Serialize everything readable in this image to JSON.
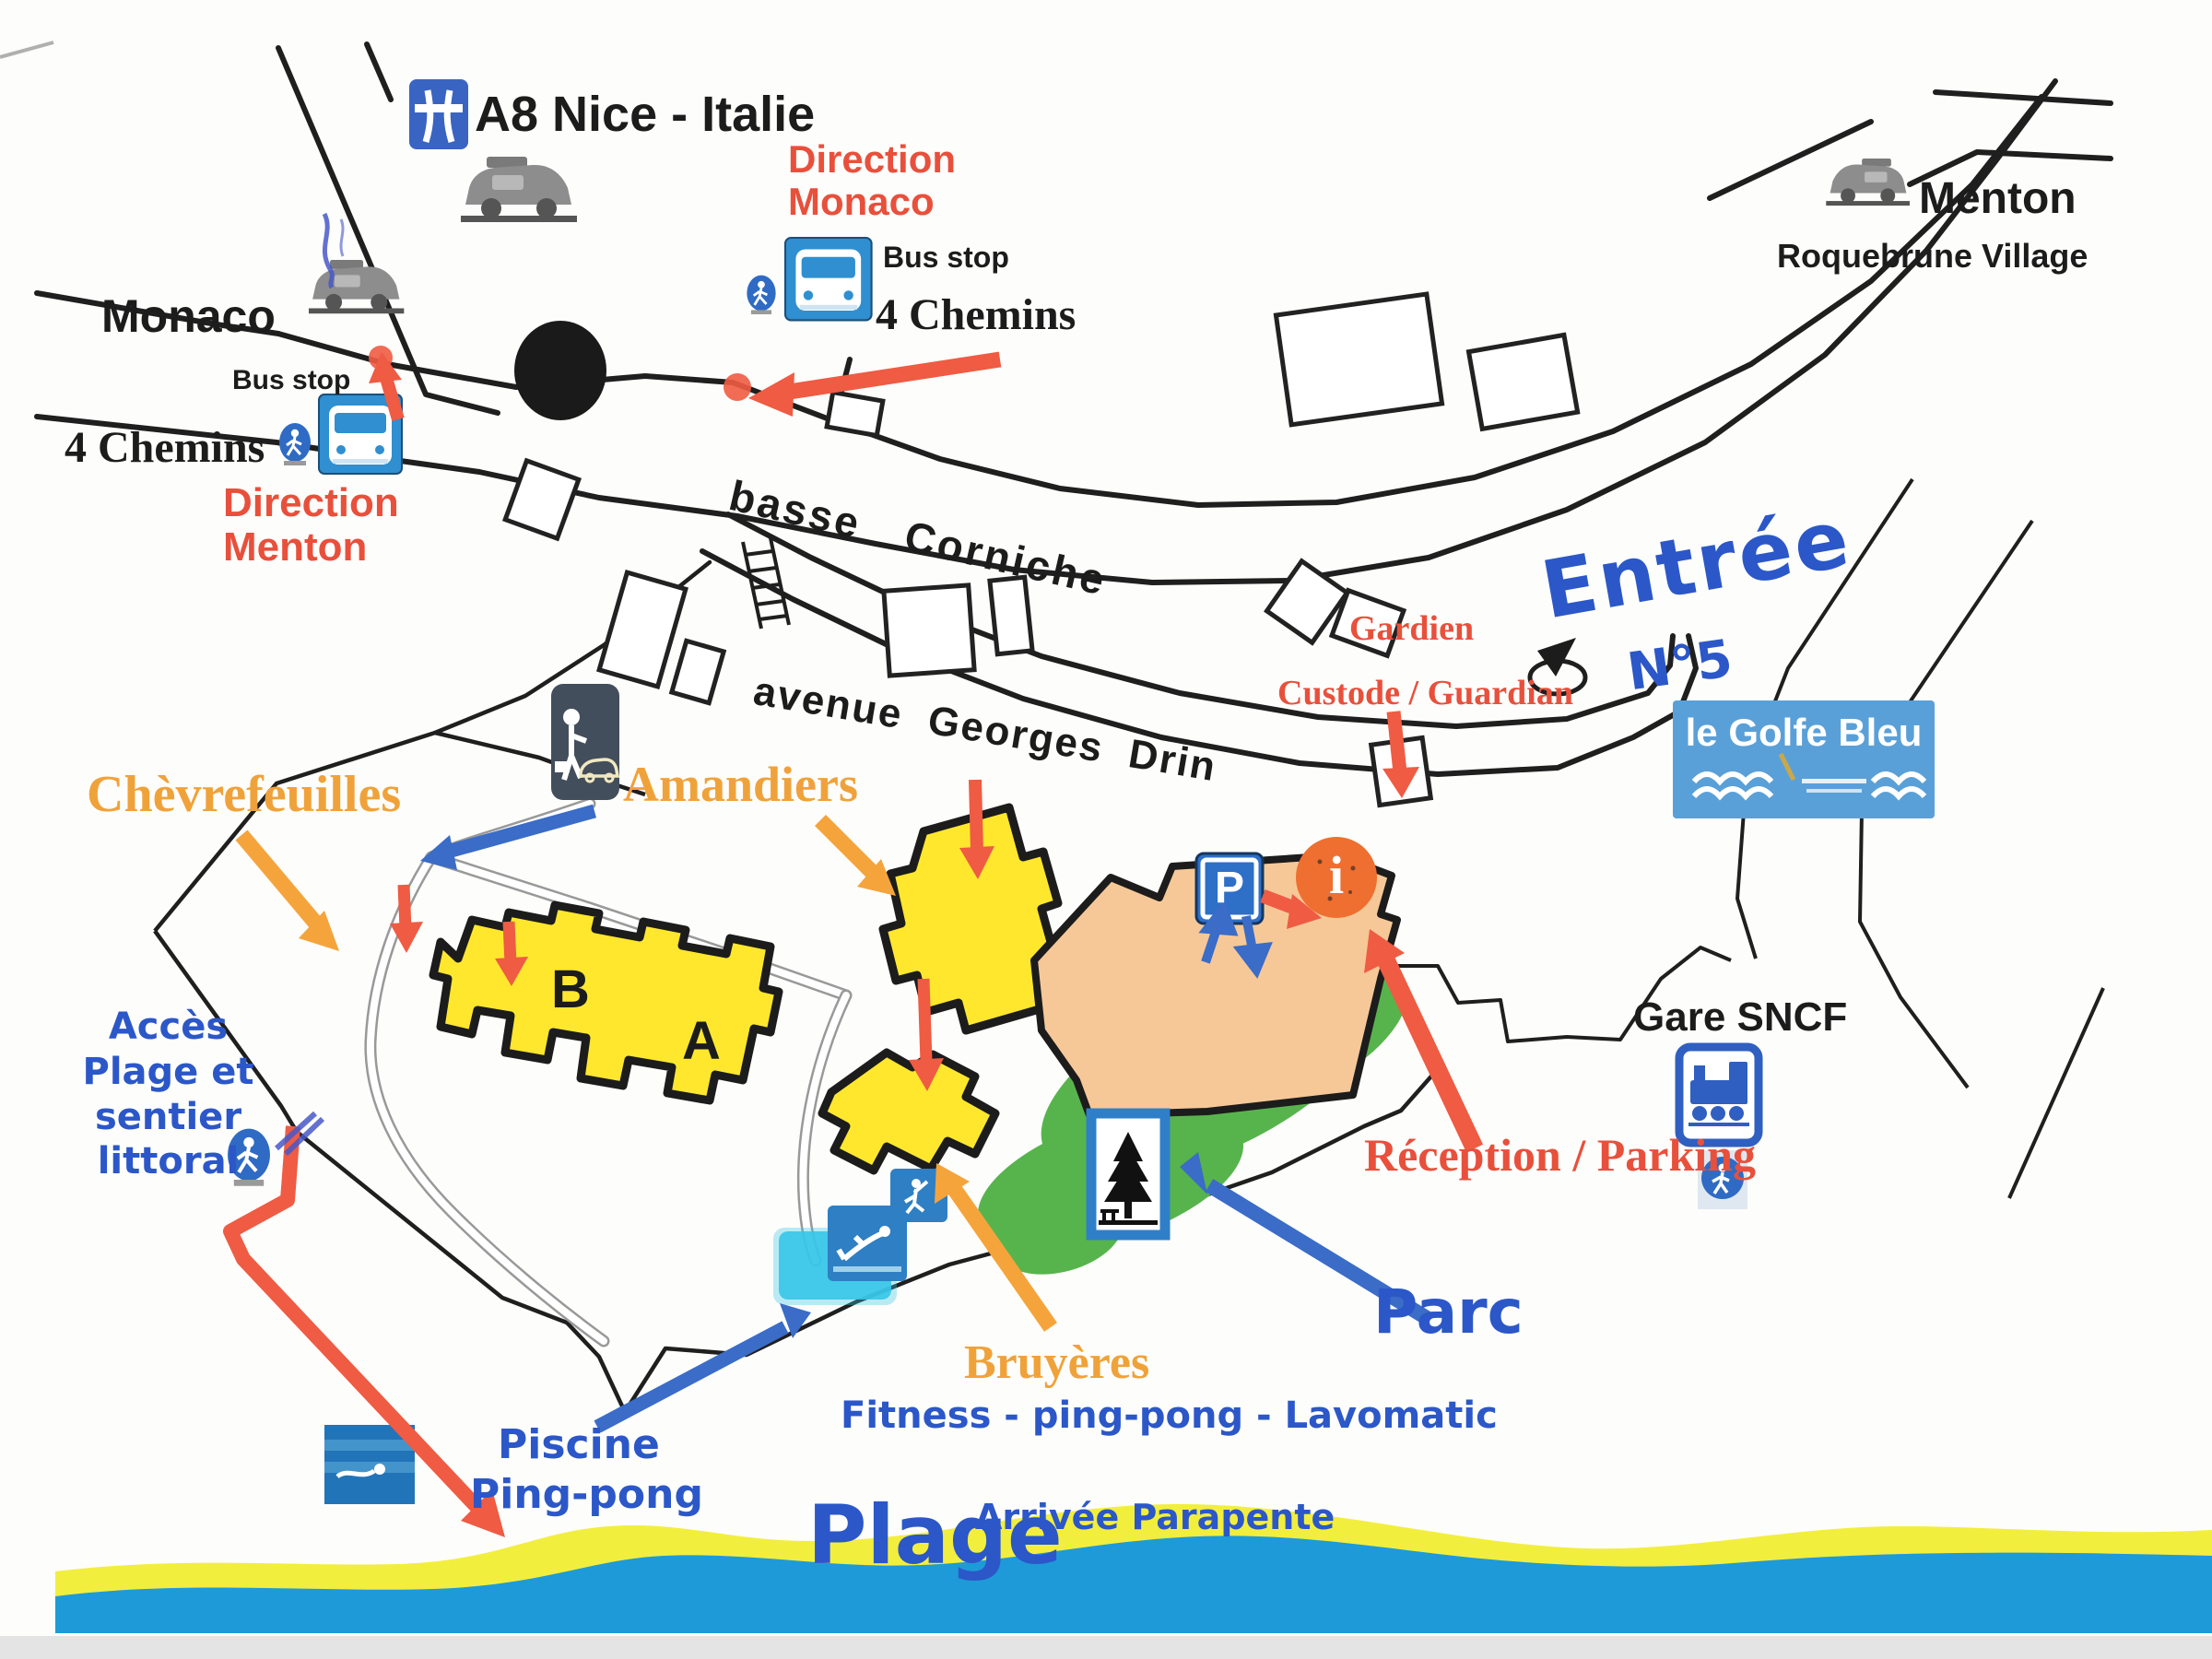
{
  "labels": {
    "a8": "A8 Nice - Italie",
    "monaco": "Monaco",
    "menton": "Menton",
    "roquebrune": "Roquebrune Village",
    "direction_monaco_l1": "Direction",
    "direction_monaco_l2": "Monaco",
    "bus_stop_center": "Bus stop",
    "chemins_center": "4 Chemins",
    "bus_stop_left": "Bus stop",
    "chemins_left": "4 Chemins",
    "direction_menton_l1": "Direction",
    "direction_menton_l2": "Menton",
    "basse_corniche": "basse Corniche",
    "avenue": "avenue Georges Drin",
    "gardien": "Gardien",
    "custode": "Custode / Guardian",
    "entree": "Entrée",
    "numero": "N°5",
    "logo": "le Golfe Bleu",
    "chevrefeuilles": "Chèvrefeuilles",
    "amandiers": "Amandiers",
    "bruyeres": "Bruyères",
    "building_b": "B",
    "building_a": "A",
    "parking_letter": "P",
    "info_letter": "i",
    "acces_l1": "Accès",
    "acces_l2": "Plage et",
    "acces_l3": "sentier",
    "acces_l4": "littoral",
    "gare": "Gare SNCF",
    "reception": "Réception / Parking",
    "parc": "Parc",
    "fitness": "Fitness  -  ping-pong  -  Lavomatic",
    "piscine_l1": "Piscine",
    "piscine_l2": "Ping-pong",
    "plage": "Plage",
    "parapente": "Arrivée Parapente"
  },
  "icons": {
    "motorway": "motorway-sign-icon",
    "car": "car-icon",
    "pedestrian": "pedestrian-icon",
    "bus": "bus-stop-sign-icon",
    "valet": "person-with-car-icon",
    "parking": "parking-p-sign-icon",
    "info": "information-circle-icon",
    "park": "park-picnic-sign-icon",
    "train": "train-station-icon",
    "diver": "swimming-pool-icon",
    "pingpong": "ping-pong-icon",
    "seaswim": "sea-swimming-icon"
  },
  "colors": {
    "red_accent": "#e8503c",
    "orange_accent": "#f0a23a",
    "blue_text": "#2b57c8",
    "sign_blue": "#2f7fc8",
    "building_yellow": "#ffe72e",
    "reception_peach": "#f6c898",
    "park_green": "#57b44c",
    "sea_blue": "#1e9ad8",
    "sand_yellow": "#f2ee3e"
  }
}
